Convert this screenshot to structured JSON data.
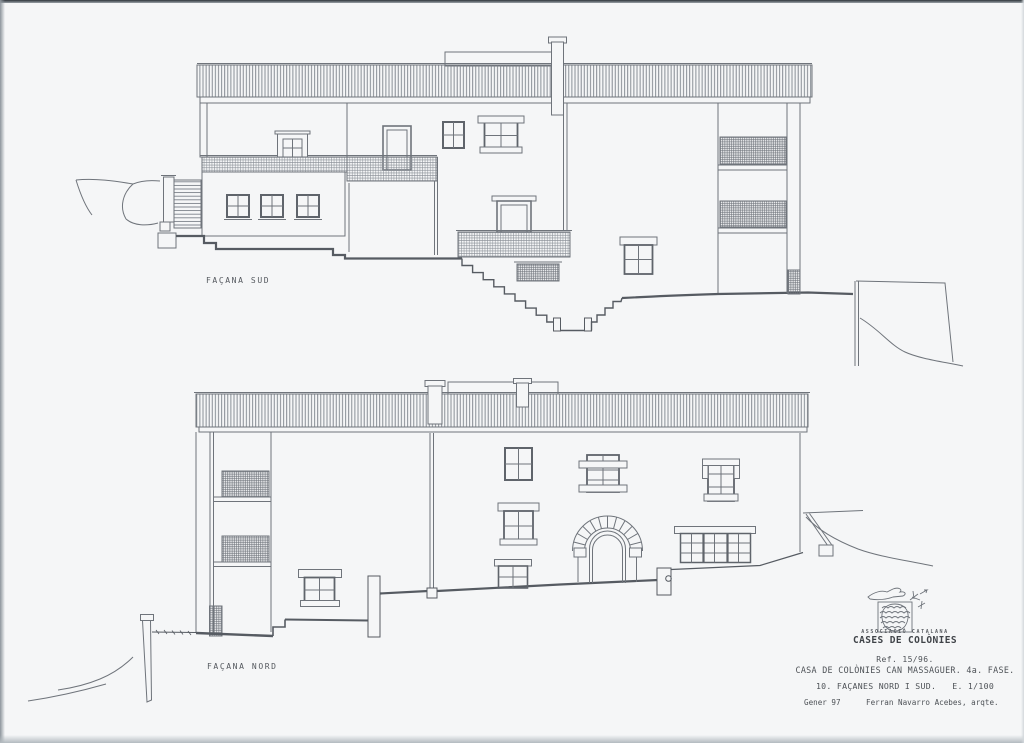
{
  "page": {
    "paper_color": "#f5f6f7",
    "line_color": "#6f747b",
    "dark_line_color": "#565b62",
    "text_color": "#54585e"
  },
  "drawings": {
    "south": {
      "label": "FAÇANA SUD"
    },
    "north": {
      "label": "FAÇANA NORD"
    }
  },
  "title_block": {
    "association_small": "ASSOCIACIÓ CATALANA",
    "association_name": "CASES DE COLÒNIES",
    "ref": "Ref. 15/96.",
    "project": "CASA DE COLÒNIES CAN MASSAGUER. 4a. FASE.",
    "sheet": "10. FAÇANES NORD I SUD.",
    "scale": "E. 1/100",
    "date": "Gener 97",
    "architect": "Ferran Navarro Acebes, arqte.",
    "logo_icon": "pine-cone-logo"
  }
}
